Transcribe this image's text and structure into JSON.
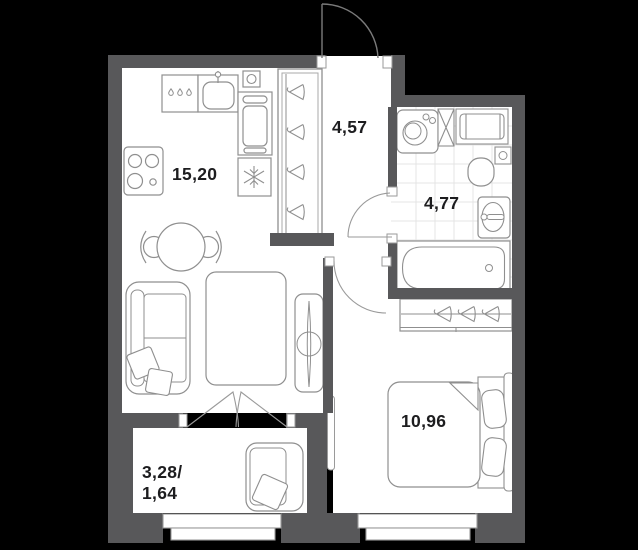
{
  "plan": {
    "colors": {
      "background": "#000000",
      "wall": "#58585a",
      "furniture_line": "#8f8f8f",
      "tile_line": "#e4e4e4",
      "label_text": "#1d1d1f",
      "floor": "#ffffff"
    },
    "rooms": {
      "kitchen_living": {
        "area": "15,20"
      },
      "hallway": {
        "area": "4,57"
      },
      "bathroom": {
        "area": "4,77"
      },
      "bedroom": {
        "area": "10,96"
      },
      "balcony": {
        "area_line1": "3,28/",
        "area_line2": "1,64"
      }
    }
  }
}
